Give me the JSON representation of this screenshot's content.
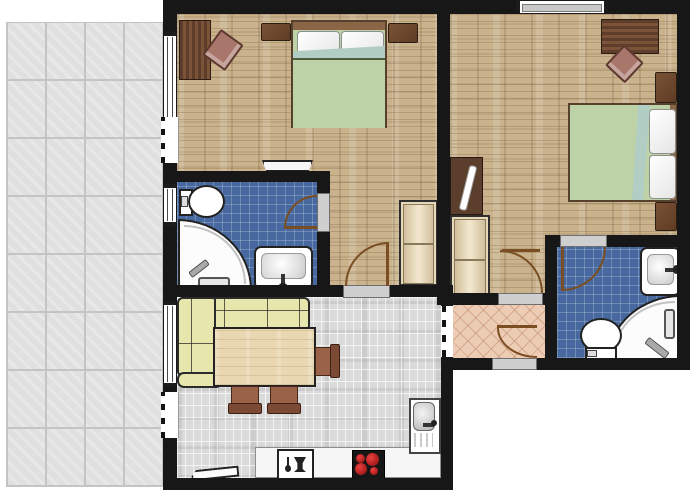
{
  "title": "Apartment floor plan",
  "colors": {
    "c-wall": "#171717",
    "c-terrace": "#e0e0e0",
    "c-wood": "#c9b28c",
    "c-bath": "#47699f",
    "c-hall": "#ecccb4",
    "c-living": "#dadada",
    "c-duvet": "#bdd2a6",
    "c-fold": "#b2cdc3",
    "c-sofa": "#e7e6ac",
    "c-table": "#e8d7b0",
    "c-arc": "#7a4e22",
    "c-burner": "#c22121",
    "c-dark-wood": "#6b4631"
  },
  "plan": {
    "rooms": [
      {
        "id": "terrace",
        "label": "Terrace",
        "floor": "large grey concrete tiles"
      },
      {
        "id": "bedroom-1",
        "label": "Bedroom 1",
        "floor": "wood parquet",
        "furniture": [
          "desk",
          "desk chair",
          "double bed with green duvet",
          "nightstand left",
          "nightstand right",
          "wardrobe",
          "wall shelf"
        ]
      },
      {
        "id": "bedroom-2",
        "label": "Bedroom 2",
        "floor": "wood parquet",
        "furniture": [
          "desk",
          "desk chair",
          "double bed with green duvet",
          "nightstand top",
          "nightstand bottom",
          "wardrobe",
          "mirror board"
        ]
      },
      {
        "id": "bathroom-1",
        "label": "Bathroom 1",
        "floor": "blue tiles",
        "fixtures": [
          "toilet",
          "corner shower",
          "washbasin"
        ]
      },
      {
        "id": "living-kitchen",
        "label": "Living room with kitchen",
        "floor": "grey mosaic tiles",
        "furniture": [
          "corner sofa",
          "dining table",
          "side dining chair",
          "dining chair 1",
          "dining chair 2",
          "kitchen counter",
          "dishwasher",
          "cooktop with four burners",
          "kitchen sink",
          "angled shelf"
        ]
      },
      {
        "id": "hallway",
        "label": "Hallway",
        "floor": "terracotta diagonal tiles"
      },
      {
        "id": "bathroom-2",
        "label": "Bathroom 2",
        "floor": "blue tiles",
        "fixtures": [
          "toilet",
          "corner shower",
          "washbasin"
        ]
      }
    ],
    "doors": [
      {
        "id": "bathroom-1-door",
        "label": "Door to bathroom 1"
      },
      {
        "id": "bedroom-1-door",
        "label": "Door to bedroom 1"
      },
      {
        "id": "bedroom-2-door",
        "label": "Door to bedroom 2"
      },
      {
        "id": "entrance-door",
        "label": "Apartment entrance door"
      },
      {
        "id": "bathroom-2-door",
        "label": "Door to bathroom 2"
      },
      {
        "id": "living-hall-passage",
        "label": "Open passage between living room and hallway"
      }
    ],
    "windows": [
      {
        "id": "bedroom-1-window",
        "label": "Bedroom 1 window to terrace"
      },
      {
        "id": "bedroom-1-terrace-door",
        "label": "Bedroom 1 terrace door opening"
      },
      {
        "id": "bathroom-1-window",
        "label": "Bathroom 1 window"
      },
      {
        "id": "living-window",
        "label": "Living room window to terrace"
      },
      {
        "id": "living-terrace-door",
        "label": "Living room terrace door opening"
      },
      {
        "id": "bedroom-2-window",
        "label": "Bedroom 2 window in top wall"
      }
    ],
    "icons": [
      "dishwasher-icon",
      "cooktop-burner-icon",
      "faucet-icon",
      "shower-handle-icon"
    ]
  }
}
